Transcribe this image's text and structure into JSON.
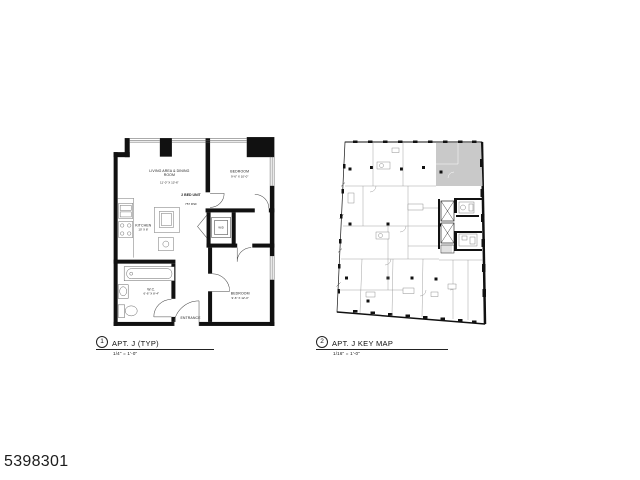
{
  "page": {
    "background": "#ffffff",
    "reference_number": "5398301"
  },
  "figures": {
    "apartment": {
      "number": "1",
      "title": "APT. J (TYP)",
      "scale": "1/4\" = 1'-0\""
    },
    "keymap": {
      "number": "2",
      "title": "APT. J KEY MAP",
      "scale": "1/16\" = 1'-0\""
    }
  },
  "apartment_plan": {
    "unit_label": "2 BED UNIT",
    "unit_area": "757 RSF",
    "rooms": {
      "living_line1": "LIVING AREA & DINING",
      "living_line2": "ROOM",
      "living_dims": "11'-0\" X 13'-6\"",
      "bedroom1": "BEDROOM",
      "bedroom1_dims": "9'-6\" X 10'-0\"",
      "bedroom2": "BEDROOM",
      "bedroom2_dims": "9'-6\" X 12'-0\"",
      "kitchen": "KITCHEN",
      "kitchen_dims": "10' X 8'",
      "wc": "W.C.",
      "wc_dims": "6'-6\" X 8'-4\"",
      "wd": "W/D",
      "entrance": "ENTRANCE"
    }
  },
  "keymap_plan": {
    "highlight_color": "#c9c9c9",
    "highlighted_unit": "APT. J"
  }
}
